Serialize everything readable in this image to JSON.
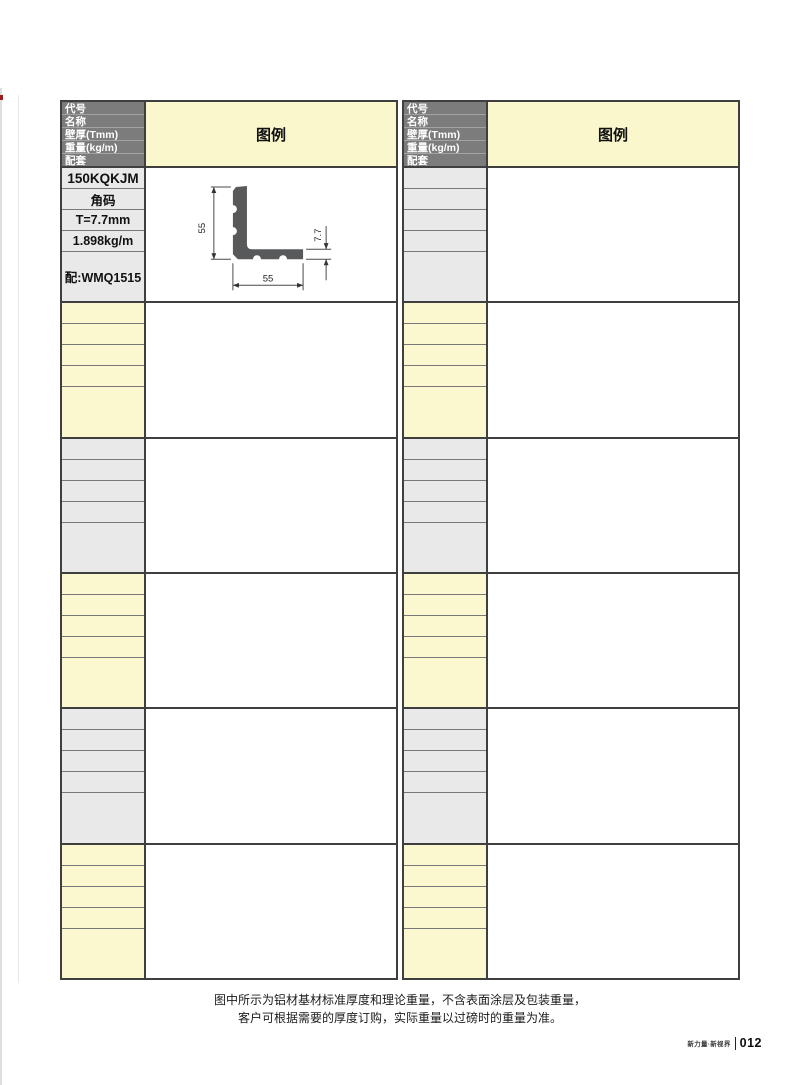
{
  "header": {
    "row_labels": [
      "代号",
      "名称",
      "壁厚(Tmm)",
      "重量(kg/m)",
      "配套"
    ],
    "legend_title": "图例"
  },
  "left_table": {
    "blocks": [
      {
        "tone": "gray",
        "code": "150KQKJM",
        "name": "角码",
        "thickness": "T=7.7mm",
        "weight": "1.898kg/m",
        "match": "配:WMQ1515"
      },
      {
        "tone": "yellow"
      },
      {
        "tone": "gray"
      },
      {
        "tone": "yellow"
      },
      {
        "tone": "gray"
      },
      {
        "tone": "yellow"
      }
    ]
  },
  "right_table": {
    "blocks": [
      {
        "tone": "gray"
      },
      {
        "tone": "yellow"
      },
      {
        "tone": "gray"
      },
      {
        "tone": "yellow"
      },
      {
        "tone": "gray"
      },
      {
        "tone": "yellow"
      }
    ]
  },
  "illustration": {
    "type": "L-angle-profile",
    "dim_height": "55",
    "dim_width": "55",
    "dim_thickness": "7.7"
  },
  "footer": {
    "note_line1": "图中所示为铝材基材标准厚度和理论重量，不含表面涂层及包装重量，",
    "note_line2": "客户可根据需要的厚度订购，实际重量以过磅时的重量为准。",
    "brand": "新力量·新视界",
    "page_number": "012"
  },
  "colors": {
    "header_gray": "#7c7c7c",
    "cell_gray": "#e9e9e9",
    "cell_yellow": "#fbf8cf",
    "legend_header_yellow": "#faf7cd",
    "border_dark": "#3f3f3f",
    "profile_fill": "#58595b"
  }
}
